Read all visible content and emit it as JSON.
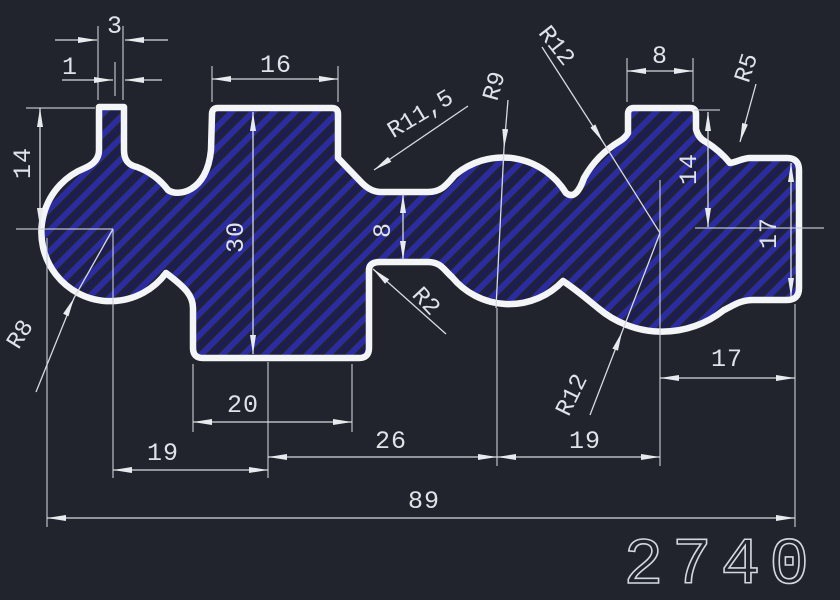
{
  "canvas": {
    "part_number": "2740"
  },
  "colors": {
    "background": "#21242d",
    "outline": "#f3f5f7",
    "hatch_primary": "#2b2ba2",
    "hatch_secondary": "#1a1a66",
    "dimension_text": "#dfe3e7"
  },
  "dimensions": {
    "stem_width": "3",
    "stem_lip": "1",
    "block_top_width": "16",
    "left_height": "14",
    "block_height": "30",
    "neck_height": "8",
    "bump_width": "8",
    "right_upper_height": "14",
    "right_block_height": "17",
    "block_bottom_width": "20",
    "span_left": "19",
    "span_mid": "26",
    "span_right": "19",
    "right_inset": "17",
    "overall_width": "89"
  },
  "radii": {
    "left_hub": "R8",
    "neck_fillet": "R11,5",
    "mid_lobe": "R9",
    "right_lobe_top": "R12",
    "right_lobe_bottom": "R12",
    "top_right_fillet": "R5",
    "small_fillet": "R2"
  }
}
